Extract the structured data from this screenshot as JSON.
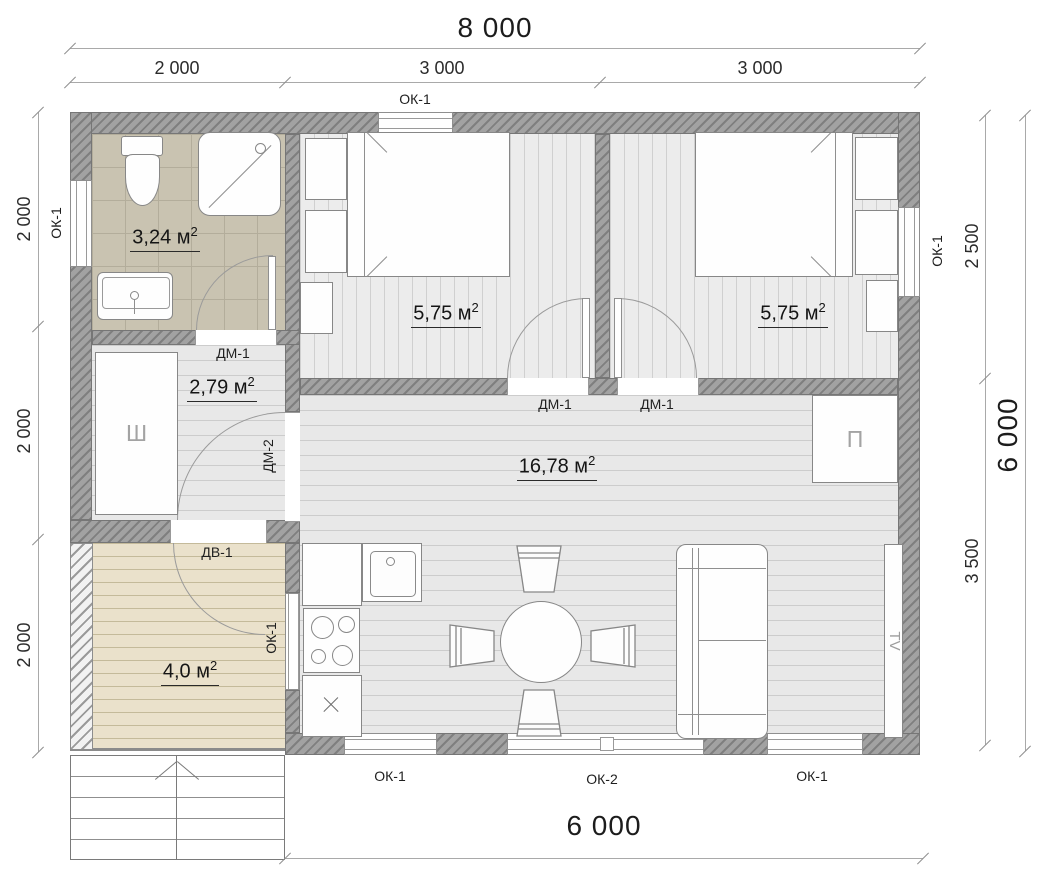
{
  "plan": {
    "dimensions": {
      "top_total": "8 000",
      "top_seg_1": "2 000",
      "top_seg_2": "3 000",
      "top_seg_3": "3 000",
      "left_seg_1": "2 000",
      "left_seg_2": "2 000",
      "left_seg_3": "2 000",
      "right_seg_1": "2 500",
      "right_seg_2": "3 500",
      "right_total": "6 000",
      "bottom_total": "6 000"
    },
    "windows": {
      "top": "ОК-1",
      "left": "ОК-1",
      "right": "ОК-1",
      "terrace": "ОК-1",
      "bottom_left": "ОК-1",
      "bottom_center": "ОК-2",
      "bottom_right": "ОК-1"
    },
    "doors": {
      "bathroom": "ДМ-1",
      "bedroom1": "ДМ-1",
      "bedroom2": "ДМ-1",
      "hall": "ДМ-2",
      "entrance": "ДВ-1"
    },
    "rooms": {
      "bathroom": {
        "area": "3,24 м",
        "sup": "2"
      },
      "hall": {
        "area": "2,79 м",
        "sup": "2"
      },
      "bedroom1": {
        "area": "5,75 м",
        "sup": "2"
      },
      "bedroom2": {
        "area": "5,75 м",
        "sup": "2"
      },
      "living": {
        "area": "16,78 м",
        "sup": "2"
      },
      "terrace": {
        "area": "4,0 м",
        "sup": "2"
      }
    },
    "furniture": {
      "wardrobe": "Ш",
      "cupboard": "П",
      "tv": "TV"
    },
    "colors": {
      "wall": "#a2a2a2",
      "tile": "#c9c3b1",
      "wood_floor": "#e8e8e8",
      "terrace_floor": "#eae1cb"
    }
  }
}
